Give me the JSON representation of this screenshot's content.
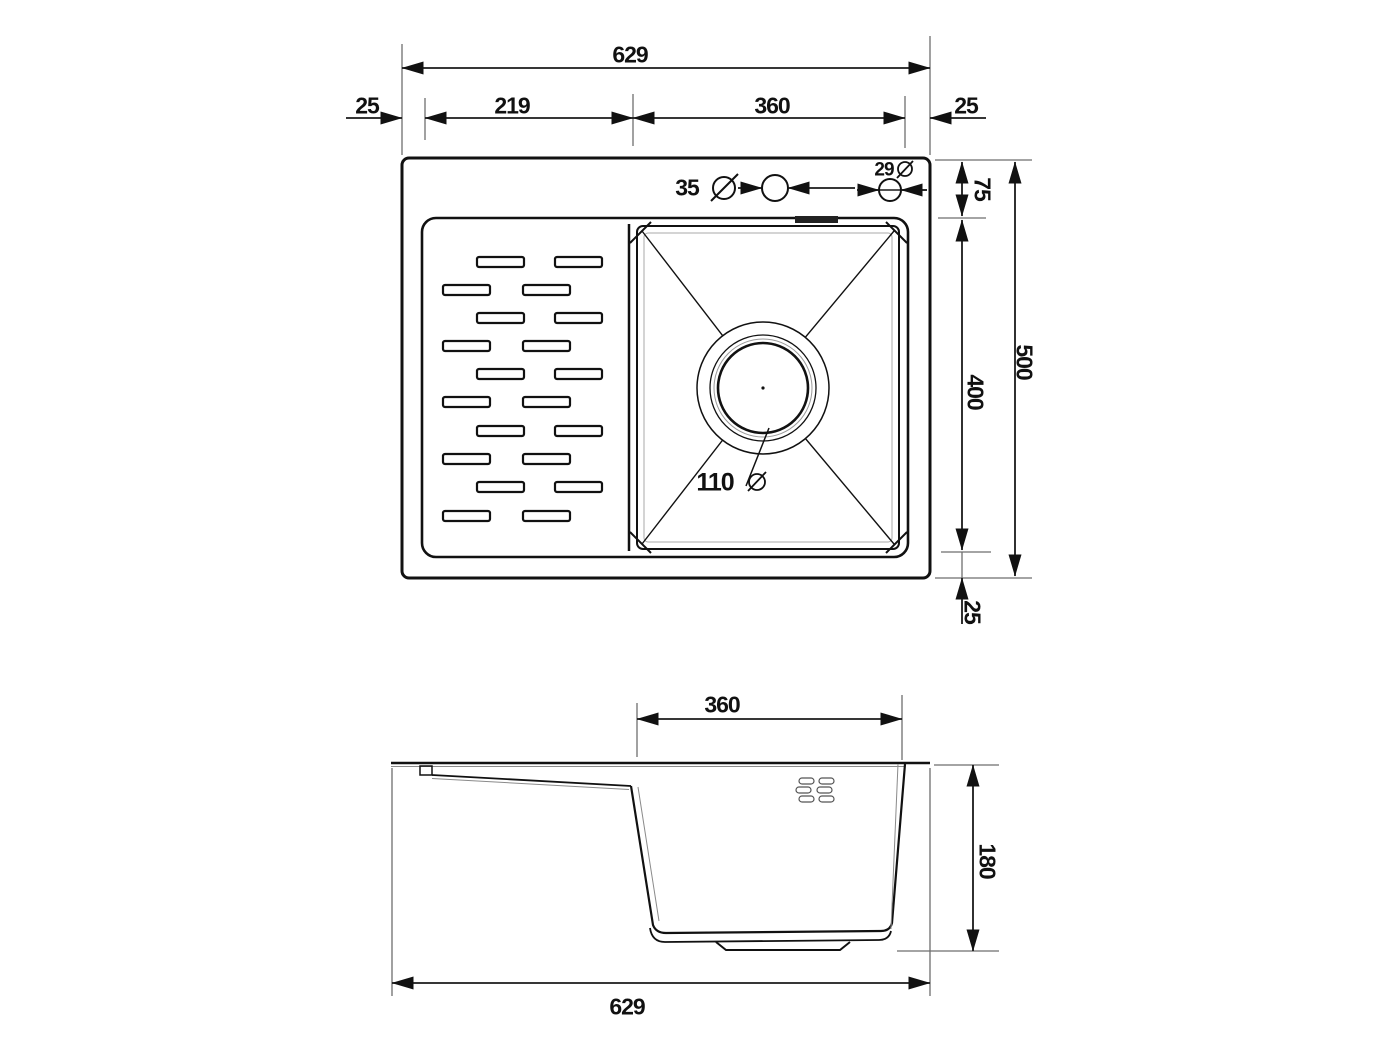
{
  "top_view": {
    "overall_width": "629",
    "rim_left": "25",
    "drainboard_width": "219",
    "bowl_width": "360",
    "rim_right": "25",
    "rim_top": "75",
    "bowl_length": "400",
    "overall_depth": "500",
    "rim_bottom": "25",
    "faucet_hole_diameter": "35",
    "secondary_hole_diameter": "29",
    "drain_diameter": "110"
  },
  "side_view": {
    "bowl_width": "360",
    "bowl_depth": "180",
    "overall_width": "629"
  },
  "icons": {
    "diameter_symbol": "diameter-icon"
  },
  "colors": {
    "object_line": "#111111",
    "dimension_line": "#1a1a1a",
    "extension_line": "#6e6e6e",
    "thin_detail_line": "#8a8a8a",
    "background": "#ffffff"
  }
}
